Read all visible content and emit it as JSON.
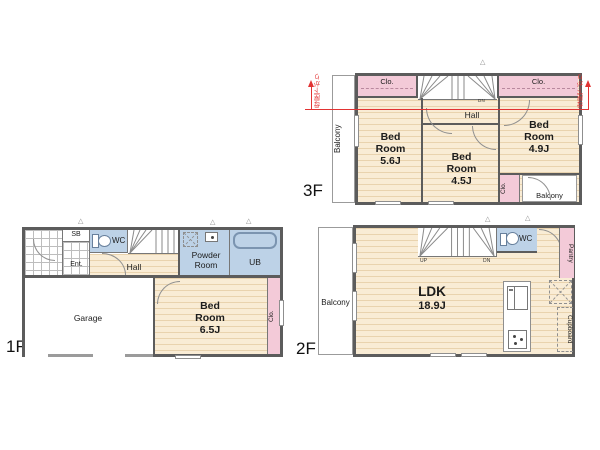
{
  "colors": {
    "wall": "#5c5c5c",
    "floor": "#f9ecd5",
    "pink": "#f3cad8",
    "blue": "#bdd2e7",
    "red": "#e23333",
    "gray": "#9b9b9b"
  },
  "icons": {
    "triangle": "△"
  },
  "f3": {
    "label": "3F",
    "balcony_left": "Balcony",
    "clo_left": "Clo.",
    "clo_right": "Clo.",
    "dn": "DN",
    "hall": "Hall",
    "bed1": {
      "l1": "Bed",
      "l2": "Room",
      "l3": "5.6J"
    },
    "bed2": {
      "l1": "Bed",
      "l2": "Room",
      "l3": "4.5J"
    },
    "bed3": {
      "l1": "Bed",
      "l2": "Room",
      "l3": "4.9J"
    },
    "clo_small": "Clo.",
    "balcony_br": "Balcony",
    "slope_left": "母屋下がり",
    "slope_right": "母屋下がり"
  },
  "f2": {
    "label": "2F",
    "balcony": "Balcony",
    "up": "UP",
    "dn": "DN",
    "wc": "WC",
    "pantry": "Pantry",
    "cupboard": "Cupboard",
    "ldk": {
      "l1": "LDK",
      "l2": "18.9J"
    }
  },
  "f1": {
    "label": "1F",
    "sb": "SB",
    "wc": "WC",
    "ent": "Ent.",
    "up": "UP",
    "hall": "Hall",
    "powder": {
      "l1": "Powder",
      "l2": "Room"
    },
    "ub": "UB",
    "garage": "Garage",
    "bed": {
      "l1": "Bed",
      "l2": "Room",
      "l3": "6.5J"
    },
    "clo": "Clo."
  }
}
